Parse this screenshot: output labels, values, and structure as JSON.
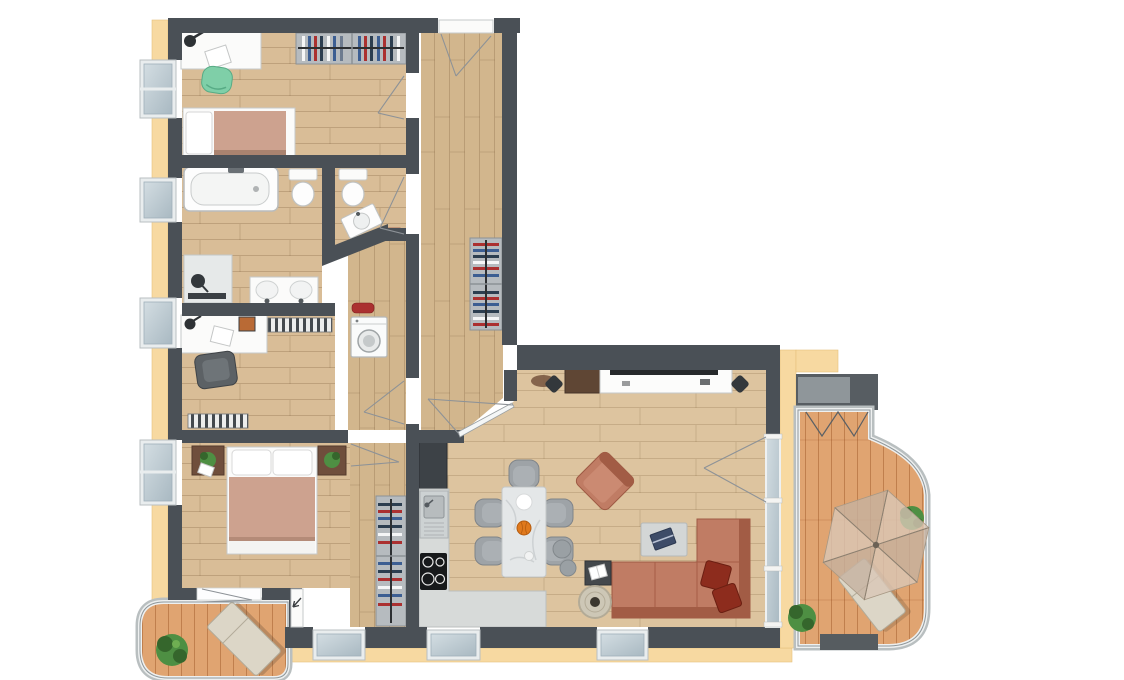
{
  "diagram": {
    "kind": "apartment-floor-plan",
    "style": "top-down rendered 3D floor plan, no text labels",
    "wings": "L-shaped layout: tall left wing with four rooms, right wing with open living-dining-kitchen, terrace on the right, small balcony bottom-left"
  },
  "palette": {
    "wall": "#4a5056",
    "cream": "#f7d9a1",
    "creamEdge": "#e5c07c",
    "floorA": "#d9bd97",
    "floorB": "#d2b68d",
    "floorC": "#ddc49f",
    "deck": "#e0a471",
    "kitchenCounter": "#d7dad9",
    "glassLight": "#d3dde2",
    "glassDark": "#a9b9c2",
    "sofa": "#c07c64",
    "sofaDark": "#a25c45",
    "cushion": "#8d2c1d",
    "blanket": "#cda28f",
    "marble": "#e4e7e8",
    "chairGrey": "#9ea3a7",
    "greenChair": "#7fcfa8",
    "plantGreen": "#4e8f43",
    "plantDark": "#35662c",
    "woodBrown": "#6f4e3c",
    "cabinetBrown": "#5f4634",
    "accentRed": "#ab3030",
    "accentNavy": "#3c5e92",
    "accentDark": "#2c3e50",
    "radiator": "#44494e",
    "white": "#fbfbfa",
    "loungerBeige": "#dcd6c7",
    "parasol": "#d9c7b2"
  },
  "rooms": [
    {
      "id": "bedroom-1",
      "position": "top-left",
      "furniture": [
        "desk with lamp and paper",
        "green chair",
        "single bed with salmon blanket",
        "wardrobe with hanging clothes"
      ]
    },
    {
      "id": "bathroom",
      "position": "left, second from top",
      "furniture": [
        "bathtub",
        "toilet",
        "walk-in shower",
        "double washbasin vanity"
      ]
    },
    {
      "id": "wc",
      "position": "center, beside bathroom",
      "furniture": [
        "toilet",
        "corner washbasin on diagonal wall",
        "red mat"
      ]
    },
    {
      "id": "office",
      "position": "left, third from top",
      "furniture": [
        "desk with lamp and picture",
        "office chair",
        "wall radiator",
        "window radiator"
      ]
    },
    {
      "id": "utility-nook",
      "position": "center",
      "furniture": [
        "washing machine",
        "red mat"
      ]
    },
    {
      "id": "hallway",
      "position": "vertical center strip",
      "furniture": [
        "entrance door with swing",
        "built-in closet with clothes",
        "diagonal glass door to living room"
      ]
    },
    {
      "id": "master-bedroom",
      "position": "bottom-left",
      "furniture": [
        "double bed with two pillows",
        "two nightstands with plants",
        "dressing wardrobe with clothes",
        "door to balcony"
      ]
    },
    {
      "id": "kitchen",
      "position": "center-bottom",
      "furniture": [
        "tall dark cabinet",
        "L-shaped concrete counter",
        "stainless sink",
        "4-burner hob"
      ]
    },
    {
      "id": "living-dining",
      "position": "right wing",
      "furniture": [
        "marble dining table with plate and pumpkin",
        "5 grey chairs",
        "terracotta armchair",
        "L-shaped terracotta sofa with 2 dark-red cushions",
        "coffee table with laptop",
        "dark side table with book",
        "round woven table",
        "2 grey poufs",
        "white TV sideboard with TV",
        "brown cabinet",
        "2 speakers",
        "doormat"
      ]
    },
    {
      "id": "terrace",
      "position": "right",
      "furniture": [
        "grey awning",
        "parasol",
        "sun lounger",
        "2 plants",
        "dark planter",
        "curved glass balustrade"
      ]
    },
    {
      "id": "balcony",
      "position": "bottom-left",
      "furniture": [
        "sun lounger",
        "plant",
        "rounded glass balustrade"
      ]
    }
  ],
  "openings": {
    "windows_left_wall": 4,
    "windows_bottom_wall": 3,
    "glass_wall_right": "full-height glazing from living room to terrace",
    "entrance": "top wall into hallway"
  }
}
